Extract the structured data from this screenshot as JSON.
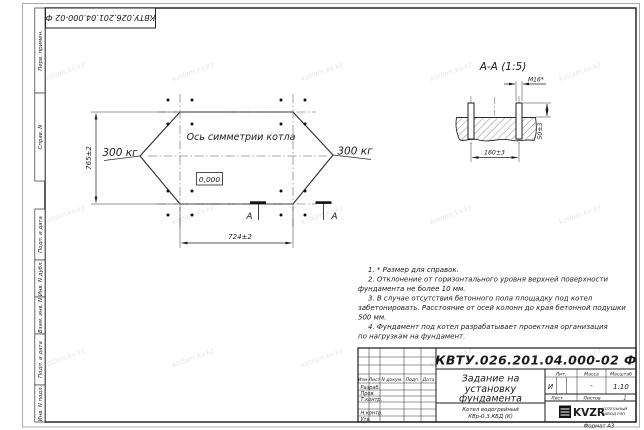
{
  "watermark": {
    "text": "kotlam.kv.kz"
  },
  "margin": {
    "cells": [
      "Перв. примен.",
      "Справ. N",
      "Подп. и дата",
      "Инв. N дубл.",
      "Взам. инв. N",
      "Подп. и дата",
      "Инв. N подл."
    ]
  },
  "plan": {
    "axis_label": "Ось симметрии котла",
    "load_left": "300 кг",
    "load_right": "300 кг",
    "elevation": "0,000",
    "dim_height": "765±2",
    "dim_width": "724±2",
    "section_letter": "А"
  },
  "section": {
    "title": "А-А (1:5)",
    "bolt_label": "М16*",
    "dim_height": "50±3",
    "dim_spacing": "160±3"
  },
  "notes": {
    "lines": [
      "1. * Размер для справок.",
      "2. Отклонение от горизонтального уровня верхней поверхности",
      "фундамента не более 10 мм.",
      "3. В случае отсутствия бетонного пола площадку под котел",
      "забетонировать. Расстояние от осей колонн до края бетонной подушки",
      "500 мм.",
      "4. Фундамент под котел разрабатывает проектная организация",
      "по нагрузкам на фундамент."
    ]
  },
  "titleblock": {
    "doc_number": "КВТУ.026.201.04.000-02 Ф",
    "title_lines": [
      "Задание на",
      "установку",
      "фундамента"
    ],
    "object_lines": [
      "Котел водогрейный",
      "КВр-0,3 КБД (К)"
    ],
    "headers": {
      "izm": "Изм.",
      "list": "Лист",
      "doc": "N докум.",
      "podp": "Подп.",
      "data": "Дата",
      "lit": "Лит.",
      "mass": "Масса",
      "scale": "Масштаб",
      "sheet": "Лист",
      "sheets": "Листов"
    },
    "rows": {
      "razrab": "Разраб.",
      "prov": "Пров.",
      "tkontr": "Т.контр.",
      "nkontr": "Н.контр.",
      "utv": "Утв."
    },
    "values": {
      "lit": "И",
      "mass": "-",
      "scale": "1:10",
      "sheets_count": "1"
    },
    "logo": {
      "name": "KVZR",
      "caption_lines": [
        "КОТЕЛЬНЫЙ",
        "ЗАВОД РЭП"
      ]
    },
    "format": "Формат А3"
  }
}
